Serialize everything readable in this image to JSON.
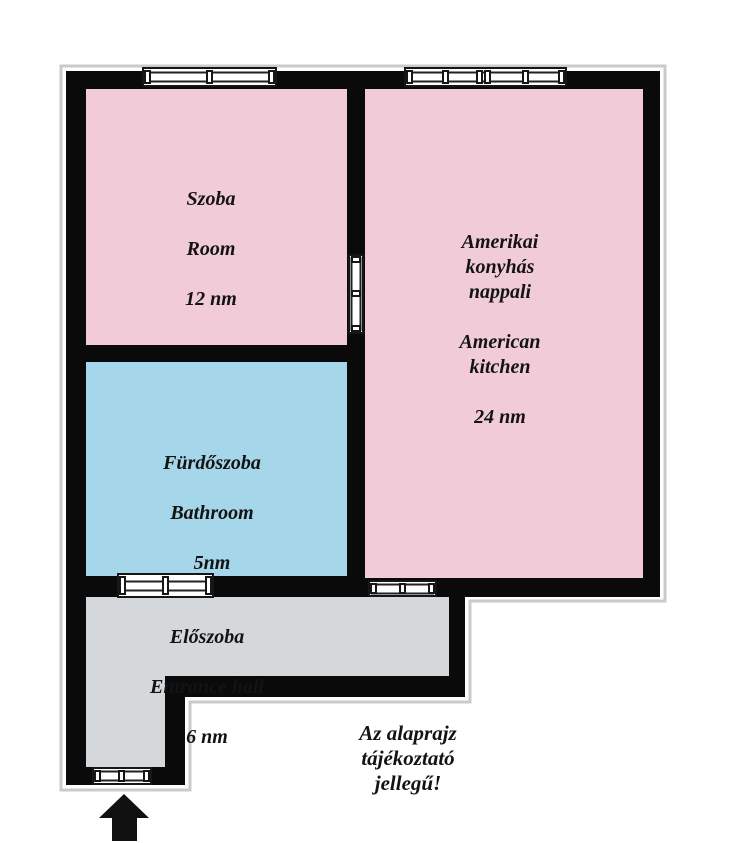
{
  "title": "Apartment floor plan",
  "colors": {
    "room_pink": "#f1ccd8",
    "bathroom_blue": "#a6d6e9",
    "hall_gray": "#d4d8db",
    "wall": "#0a0a0a",
    "background": "#ffffff"
  },
  "rooms": {
    "szoba": {
      "name_hu": "Szoba",
      "name_en": "Room",
      "area": "12 nm",
      "fill": "#f1ccd8"
    },
    "kitchen": {
      "name_hu": "Amerikai\nkonyhás\nnappali",
      "name_en": "American\nkitchen",
      "area": "24 nm",
      "fill": "#f1ccd8"
    },
    "bathroom": {
      "name_hu": "Fürdőszoba",
      "name_en": "Bathroom",
      "area": "5nm",
      "fill": "#a6d6e9"
    },
    "hall": {
      "name_hu": "Előszoba",
      "name_en": "Entrance hall",
      "area": "6 nm",
      "fill": "#d4d8db"
    }
  },
  "disclaimer": "Az alaprajz\ntájékoztató\njellegű!"
}
